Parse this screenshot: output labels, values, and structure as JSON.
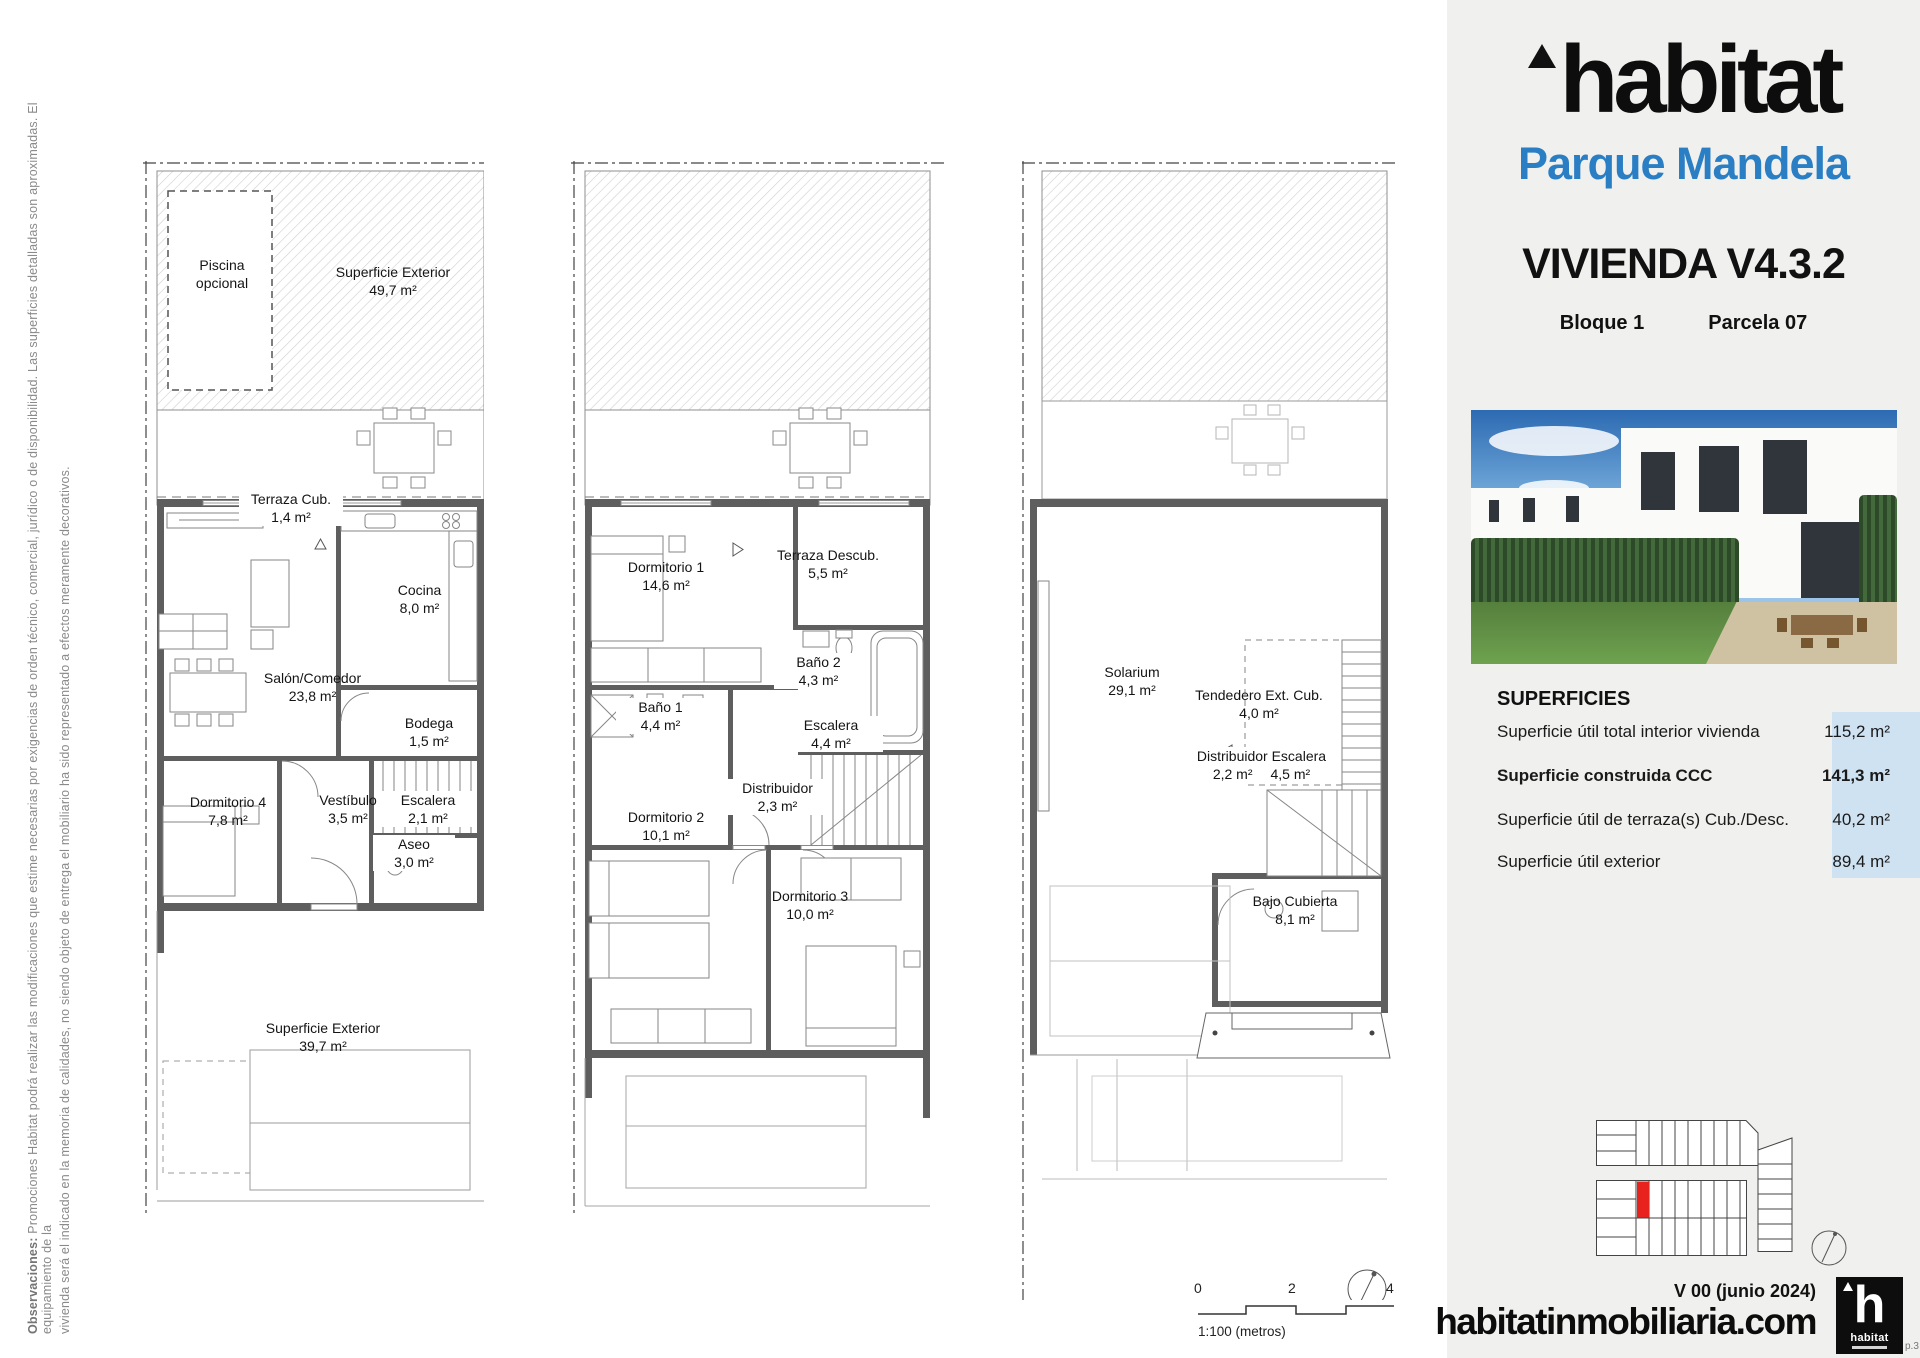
{
  "document": {
    "disclaimer": {
      "bold": "Observaciones:",
      "line1": " Promociones Habitat podrá realizar las modificaciones que estime necesarias por exigencias de orden técnico, comercial, jurídico o de disponibilidad. Las superficies detalladas son aproximadas. El equipamiento de la",
      "line2": "vivienda será el indicado en la memoria de calidades, no siendo objeto de entrega el mobiliario ha sido representado a efectos meramente decorativos."
    }
  },
  "sidebar": {
    "brand": "habitat",
    "project": "Parque Mandela",
    "title": "VIVIENDA V4.3.2",
    "block": "Bloque 1",
    "parcel": "Parcela 07",
    "superficies": {
      "heading": "SUPERFICIES",
      "rows": [
        {
          "label": "Superficie útil total interior vivienda",
          "value": "115,2 m²"
        },
        {
          "label": "Superficie construida CCC",
          "value": "141,3 m²"
        },
        {
          "label": "Superficie útil de terraza(s) Cub./Desc.",
          "value": "40,2 m²"
        },
        {
          "label": "Superficie útil exterior",
          "value": "89,4 m²"
        }
      ]
    },
    "version": "V 00 (junio 2024)",
    "website": "habitatinmobiliaria.com",
    "logo_letter": "h",
    "logo_text": "habitat",
    "page_ref": "p.3",
    "colors": {
      "brand_blue": "#2a7ec4",
      "value_bg": "#cfe2f2",
      "plot_red": "#e8231e"
    }
  },
  "plans": {
    "floor0": {
      "piscina_l1": "Piscina",
      "piscina_l2": "opcional",
      "sup_ext_top": {
        "name": "Superficie Exterior",
        "area": "49,7 m²"
      },
      "terraza_cub": {
        "name": "Terraza Cub.",
        "area": "1,4 m²"
      },
      "cocina": {
        "name": "Cocina",
        "area": "8,0 m²"
      },
      "salon": {
        "name": "Salón/Comedor",
        "area": "23,8 m²"
      },
      "bodega": {
        "name": "Bodega",
        "area": "1,5 m²"
      },
      "dormitorio4": {
        "name": "Dormitorio 4",
        "area": "7,8 m²"
      },
      "vestibulo": {
        "name": "Vestíbulo",
        "area": "3,5 m²"
      },
      "escalera": {
        "name": "Escalera",
        "area": "2,1 m²"
      },
      "aseo": {
        "name": "Aseo",
        "area": "3,0 m²"
      },
      "sup_ext_bottom": {
        "name": "Superficie Exterior",
        "area": "39,7 m²"
      }
    },
    "floor1": {
      "dormitorio1": {
        "name": "Dormitorio 1",
        "area": "14,6 m²"
      },
      "terraza_descub": {
        "name": "Terraza Descub.",
        "area": "5,5 m²"
      },
      "bano2": {
        "name": "Baño 2",
        "area": "4,3 m²"
      },
      "bano1": {
        "name": "Baño 1",
        "area": "4,4 m²"
      },
      "escalera": {
        "name": "Escalera",
        "area": "4,4 m²"
      },
      "distribuidor": {
        "name": "Distribuidor",
        "area": "2,3 m²"
      },
      "dormitorio2": {
        "name": "Dormitorio 2",
        "area": "10,1 m²"
      },
      "dormitorio3": {
        "name": "Dormitorio 3",
        "area": "10,0 m²"
      }
    },
    "floor2": {
      "solarium": {
        "name": "Solarium",
        "area": "29,1 m²"
      },
      "tendedero": {
        "name": "Tendedero Ext. Cub.",
        "area": "4,0 m²"
      },
      "distribuidor_escalera": {
        "name": "Distribuidor Escalera",
        "area1": "2,2 m²",
        "area2": "4,5 m²"
      },
      "bajo_cubierta": {
        "name": "Bajo Cubierta",
        "area": "8,1 m²"
      }
    }
  },
  "scalebar": {
    "t0": "0",
    "t1": "2",
    "t2": "4",
    "caption": "1:100 (metros)"
  }
}
